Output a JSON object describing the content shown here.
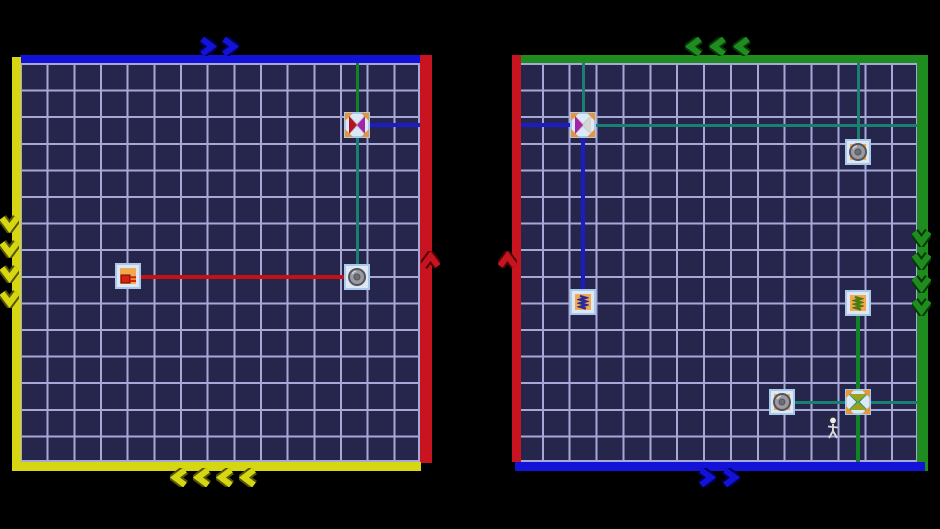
{
  "app": {
    "name": "wire-spool-puzzle-game",
    "visible_text": []
  },
  "colors": {
    "bg": "#000000",
    "cell": "#26264c",
    "line": "#a6a8d8",
    "blue": "#1212d8",
    "blue_dark": "#000055",
    "red": "#c81420",
    "red_dark": "#4d0505",
    "yellow": "#d6d612",
    "yellow_dark": "#55550a",
    "green": "#1e8c1e",
    "green_dark": "#063806",
    "wire_teal": "#1a7f70",
    "wire_green": "#128226",
    "wire_blue": "#1c1cc4",
    "wire_red": "#c41212",
    "tile": "#dce8f6",
    "tile_border": "#aac8e8",
    "tile_inner": "#f2a84e",
    "spool_gray": "#9a9aa0",
    "spool_gray_dark": "#54545c",
    "cross_orange": "#e8953a",
    "string_gray": "#c4c4cc"
  },
  "grid": {
    "cols": 15,
    "rows": 15
  },
  "panels": [
    {
      "name": "left-board",
      "grid_rect": {
        "x": 20,
        "y": 63,
        "w": 400,
        "h": 399
      },
      "borders": [
        {
          "side": "top",
          "color": "blue",
          "x": 20,
          "y": 55,
          "w": 400,
          "h": 8
        },
        {
          "side": "right",
          "color": "red",
          "x": 420,
          "y": 55,
          "w": 12,
          "h": 408
        },
        {
          "side": "left",
          "color": "yellow",
          "x": 12,
          "y": 57,
          "w": 9,
          "h": 414
        },
        {
          "side": "bottom",
          "color": "yellow",
          "x": 12,
          "y": 462,
          "w": 409,
          "h": 9
        }
      ],
      "chevron_groups": [
        {
          "dir": "right",
          "color": "blue",
          "x": 197,
          "y": 37,
          "count": 2,
          "spacing": 22
        },
        {
          "dir": "down",
          "color": "yellow",
          "x": 0,
          "y": 213,
          "count": 4,
          "spacing": 25
        },
        {
          "dir": "left",
          "color": "yellow",
          "x": 170,
          "y": 468,
          "count": 4,
          "spacing": 23
        },
        {
          "dir": "up",
          "color": "red",
          "x": 421,
          "y": 251,
          "count": 1,
          "spacing": 23
        }
      ],
      "wires": [
        {
          "x1": 357,
          "y1": 63,
          "x2": 357,
          "y2": 125,
          "color": "wire_green",
          "w": 3
        },
        {
          "x1": 357,
          "y1": 125,
          "x2": 357,
          "y2": 277,
          "color": "wire_teal",
          "w": 3
        },
        {
          "x1": 357,
          "y1": 125,
          "x2": 421,
          "y2": 125,
          "color": "wire_blue",
          "w": 4
        },
        {
          "x1": 128,
          "y1": 277,
          "x2": 357,
          "y2": 277,
          "color": "wire_red",
          "w": 4
        }
      ],
      "nodes": [
        {
          "id": "left-cross-spool",
          "type": "cross",
          "x": 357,
          "y": 125,
          "c1": "#b51322",
          "c2": "#a424a8",
          "orient": "h",
          "string": "#c4c4cc"
        },
        {
          "id": "left-red-plug",
          "type": "plug",
          "x": 128,
          "y": 276,
          "inner": true
        },
        {
          "id": "left-round-spool",
          "type": "round",
          "x": 357,
          "y": 277,
          "inner": false
        }
      ]
    },
    {
      "name": "right-board",
      "grid_rect": {
        "x": 515,
        "y": 63,
        "w": 403,
        "h": 399
      },
      "borders": [
        {
          "side": "top",
          "color": "green",
          "x": 512,
          "y": 55,
          "w": 413,
          "h": 8
        },
        {
          "side": "left",
          "color": "red",
          "x": 512,
          "y": 55,
          "w": 9,
          "h": 407
        },
        {
          "side": "right",
          "color": "green",
          "x": 917,
          "y": 55,
          "w": 11,
          "h": 416
        },
        {
          "side": "bottom",
          "color": "blue",
          "x": 515,
          "y": 462,
          "w": 410,
          "h": 9
        }
      ],
      "chevron_groups": [
        {
          "dir": "left",
          "color": "green",
          "x": 685,
          "y": 37,
          "count": 3,
          "spacing": 24
        },
        {
          "dir": "up",
          "color": "red",
          "x": 498,
          "y": 251,
          "count": 1,
          "spacing": 23
        },
        {
          "dir": "down",
          "color": "green",
          "x": 912,
          "y": 227,
          "count": 4,
          "spacing": 23
        },
        {
          "dir": "right",
          "color": "blue",
          "x": 696,
          "y": 468,
          "count": 2,
          "spacing": 24
        }
      ],
      "wires": [
        {
          "x1": 583,
          "y1": 63,
          "x2": 583,
          "y2": 125,
          "color": "wire_teal",
          "w": 3
        },
        {
          "x1": 521,
          "y1": 125,
          "x2": 583,
          "y2": 125,
          "color": "wire_blue",
          "w": 4
        },
        {
          "x1": 583,
          "y1": 125,
          "x2": 918,
          "y2": 125,
          "color": "wire_teal",
          "w": 3
        },
        {
          "x1": 583,
          "y1": 125,
          "x2": 583,
          "y2": 302,
          "color": "wire_blue",
          "w": 4
        },
        {
          "x1": 858,
          "y1": 63,
          "x2": 858,
          "y2": 152,
          "color": "wire_teal",
          "w": 3
        },
        {
          "x1": 858,
          "y1": 303,
          "x2": 858,
          "y2": 462,
          "color": "wire_green",
          "w": 4
        },
        {
          "x1": 782,
          "y1": 402,
          "x2": 918,
          "y2": 402,
          "color": "wire_teal",
          "w": 3
        }
      ],
      "nodes": [
        {
          "id": "right-cross-spool-top",
          "type": "cross",
          "x": 583,
          "y": 125,
          "c1": "#a424a8",
          "c2": "#d6d6d0",
          "orient": "h",
          "string": "#c4c4cc"
        },
        {
          "id": "right-blue-coil",
          "type": "coil",
          "x": 583,
          "y": 302,
          "coil": "#2a2a9a",
          "inner": true
        },
        {
          "id": "right-round-spool-top",
          "type": "round",
          "x": 858,
          "y": 152,
          "inner": true
        },
        {
          "id": "right-green-coil",
          "type": "coil",
          "x": 858,
          "y": 303,
          "coil": "#4a7a12",
          "inner": true
        },
        {
          "id": "right-cross-spool-bottom",
          "type": "cross",
          "x": 858,
          "y": 402,
          "c1": "#98a51c",
          "c2": "#98a51c",
          "orient": "v",
          "string": "#1f8f80"
        },
        {
          "id": "right-round-spool-bottom",
          "type": "round",
          "x": 782,
          "y": 402,
          "inner": true
        }
      ]
    }
  ],
  "character": {
    "x": 833,
    "y": 427
  }
}
